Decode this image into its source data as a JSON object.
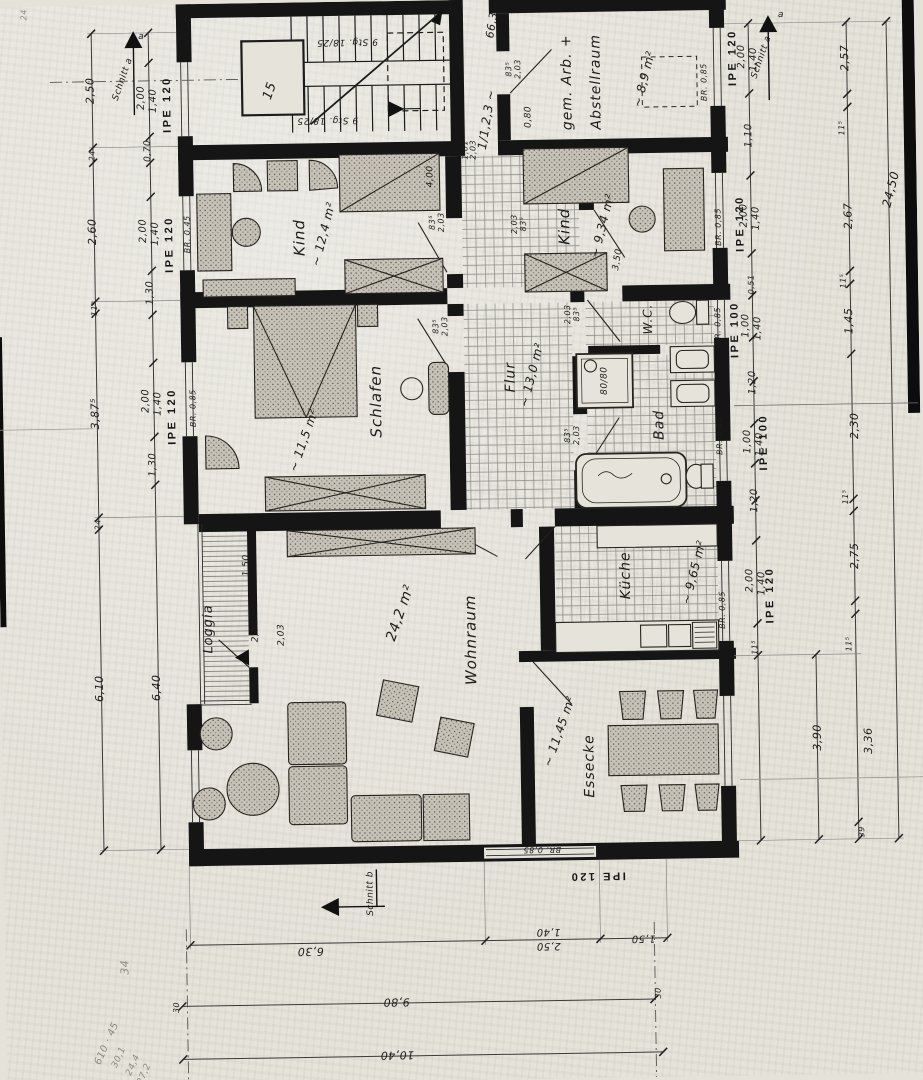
{
  "palette": {
    "paper": "#e6e3db",
    "ink": "#151514",
    "hatch": "#8a8a85",
    "pencil": "#8e8b84",
    "wall": "#151515"
  },
  "labels": {
    "rooms": [
      {
        "n": "room-note-stair-shaft",
        "t": "15",
        "x": 278,
        "y": 88,
        "r": -70,
        "s": 13
      },
      {
        "n": "room-label-gem-arb-1",
        "t": "gem. Arb. +",
        "x": 575,
        "y": 84,
        "r": -90,
        "s": 14,
        "c": "big"
      },
      {
        "n": "room-label-gem-arb-2",
        "t": "Abstellraum",
        "x": 604,
        "y": 84,
        "r": -90,
        "s": 14,
        "c": "big"
      },
      {
        "n": "room-area-gem-arb",
        "t": "~ 8,9 m²",
        "x": 652,
        "y": 82,
        "r": -75,
        "s": 12
      },
      {
        "n": "room-label-kind-1",
        "t": "Kind",
        "x": 305,
        "y": 235,
        "r": -90,
        "s": 15,
        "c": "big"
      },
      {
        "n": "room-area-kind-1",
        "t": "~ 12,4 m²",
        "x": 329,
        "y": 232,
        "r": -75,
        "s": 12
      },
      {
        "n": "room-label-kind-2",
        "t": "Kind",
        "x": 570,
        "y": 228,
        "r": -90,
        "s": 15,
        "c": "big"
      },
      {
        "n": "room-area-kind-2",
        "t": "~ 9,34 m²",
        "x": 608,
        "y": 228,
        "r": -75,
        "s": 12
      },
      {
        "n": "room-label-schlafen",
        "t": "Schlafen",
        "x": 379,
        "y": 400,
        "r": -90,
        "s": 15,
        "c": "big"
      },
      {
        "n": "room-area-schlafen",
        "t": "~ 11,5 m²",
        "x": 306,
        "y": 438,
        "r": -70,
        "s": 12
      },
      {
        "n": "room-label-flur",
        "t": "Flur",
        "x": 514,
        "y": 378,
        "r": -90,
        "s": 14,
        "c": "big"
      },
      {
        "n": "room-area-flur",
        "t": "~ 13,0 m²",
        "x": 535,
        "y": 376,
        "r": -75,
        "s": 12
      },
      {
        "n": "room-label-wc",
        "t": "W.C.",
        "x": 652,
        "y": 322,
        "r": -90,
        "s": 12,
        "c": "big"
      },
      {
        "n": "room-label-bad",
        "t": "Bad",
        "x": 662,
        "y": 428,
        "r": -90,
        "s": 14,
        "c": "big"
      },
      {
        "n": "room-label-kueche",
        "t": "Küche",
        "x": 626,
        "y": 578,
        "r": -90,
        "s": 14,
        "c": "big"
      },
      {
        "n": "room-area-kueche",
        "t": "~ 9,65 m²",
        "x": 694,
        "y": 576,
        "r": -75,
        "s": 12
      },
      {
        "n": "room-label-wohnraum",
        "t": "Wohnraum",
        "x": 470,
        "y": 640,
        "r": -90,
        "s": 15,
        "c": "big"
      },
      {
        "n": "room-area-wohnraum",
        "t": "24,2 m²",
        "x": 400,
        "y": 612,
        "r": -70,
        "s": 14
      },
      {
        "n": "room-label-essecke",
        "t": "Essecke",
        "x": 587,
        "y": 768,
        "r": -90,
        "s": 14,
        "c": "big"
      },
      {
        "n": "room-area-essecke",
        "t": "~ 11,45 m²",
        "x": 557,
        "y": 733,
        "r": -70,
        "s": 12
      },
      {
        "n": "room-label-loggia",
        "t": "Loggia",
        "x": 208,
        "y": 625,
        "r": -90,
        "s": 13,
        "c": "big"
      }
    ],
    "stairs": [
      {
        "n": "stair-note-upper-flight",
        "t": "9 Stg. 18/25",
        "x": 356,
        "y": 40,
        "r": 180,
        "s": 9
      },
      {
        "n": "stair-note-lower-flight",
        "t": "9 Stg. 18/25",
        "x": 335,
        "y": 118,
        "r": 180,
        "s": 9
      }
    ],
    "fixtures": [
      {
        "n": "shower-size-note",
        "t": "80/80",
        "x": 608,
        "y": 383,
        "r": -90,
        "s": 9
      }
    ],
    "beams": [
      {
        "n": "beam-label-left-1",
        "t": "IPE 120",
        "x": 175,
        "y": 100,
        "r": -90,
        "s": 11,
        "c": "beam"
      },
      {
        "n": "beam-label-left-2",
        "t": "IPE 120",
        "x": 175,
        "y": 240,
        "r": -90,
        "s": 11,
        "c": "beam"
      },
      {
        "n": "beam-label-left-3",
        "t": "IPE 120",
        "x": 175,
        "y": 412,
        "r": -90,
        "s": 11,
        "c": "beam"
      },
      {
        "n": "beam-label-right-1",
        "t": "IPE 120",
        "x": 741,
        "y": 62,
        "r": -90,
        "s": 11,
        "c": "beam"
      },
      {
        "n": "beam-label-right-2",
        "t": "IPE 120",
        "x": 746,
        "y": 228,
        "r": -90,
        "s": 11,
        "c": "beam"
      },
      {
        "n": "beam-label-right-3",
        "t": "IPE 100",
        "x": 739,
        "y": 334,
        "r": -90,
        "s": 11,
        "c": "beam"
      },
      {
        "n": "beam-label-right-4",
        "t": "IPE 100",
        "x": 766,
        "y": 447,
        "r": -90,
        "s": 11,
        "c": "beam"
      },
      {
        "n": "beam-label-right-5",
        "t": "IPE 120",
        "x": 770,
        "y": 600,
        "r": -90,
        "s": 11,
        "c": "beam"
      },
      {
        "n": "beam-label-bottom",
        "t": "IPE 120",
        "x": 593,
        "y": 878,
        "r": 180,
        "s": 11,
        "c": "beam"
      }
    ],
    "parapets": [
      {
        "n": "parapet-note",
        "t": "BR. 0,45",
        "x": 193,
        "y": 230,
        "r": -90,
        "s": 8
      },
      {
        "n": "parapet-note",
        "t": "BR. 0,85",
        "x": 196,
        "y": 404,
        "r": -90,
        "s": 8
      },
      {
        "n": "parapet-note",
        "t": "BR. 0,85",
        "x": 712,
        "y": 86,
        "r": -90,
        "s": 8
      },
      {
        "n": "parapet-note",
        "t": "BR. 0,85",
        "x": 724,
        "y": 231,
        "r": -90,
        "s": 8
      },
      {
        "n": "parapet-note",
        "t": "BR. 0,85",
        "x": 722,
        "y": 330,
        "r": -90,
        "s": 8
      },
      {
        "n": "parapet-note",
        "t": "BR. 0,85",
        "x": 722,
        "y": 440,
        "r": -90,
        "s": 8
      },
      {
        "n": "parapet-note",
        "t": "BR. 0,85",
        "x": 722,
        "y": 614,
        "r": -90,
        "s": 8
      },
      {
        "n": "parapet-note",
        "t": "BR. 0,85",
        "x": 538,
        "y": 851,
        "r": 180,
        "s": 8
      }
    ],
    "sections": [
      {
        "n": "section-label-a-left",
        "t": "Schnitt a",
        "x": 131,
        "y": 74,
        "r": -70,
        "s": 9
      },
      {
        "n": "section-letter-a-left",
        "t": "a",
        "x": 150,
        "y": 32,
        "r": 0,
        "s": 9
      },
      {
        "n": "section-label-a-right",
        "t": "Schnitt a",
        "x": 770,
        "y": 62,
        "r": -70,
        "s": 9
      },
      {
        "n": "section-letter-a-right",
        "t": "a",
        "x": 790,
        "y": 20,
        "r": 0,
        "s": 9
      },
      {
        "n": "section-label-b",
        "t": "Schnitt b",
        "x": 366,
        "y": 892,
        "r": -90,
        "s": 9
      }
    ],
    "dims_left": [
      {
        "t": "2,50",
        "x": 98,
        "y": 85,
        "r": -90,
        "s": 11
      },
      {
        "t": "24",
        "x": 99,
        "y": 150,
        "r": -90,
        "s": 8
      },
      {
        "t": "2,60",
        "x": 98,
        "y": 226,
        "r": -90,
        "s": 11
      },
      {
        "t": "11⁵",
        "x": 99,
        "y": 303,
        "r": -90,
        "s": 8
      },
      {
        "t": "3,87⁵",
        "x": 98,
        "y": 408,
        "r": -90,
        "s": 11
      },
      {
        "t": "24",
        "x": 99,
        "y": 519,
        "r": -90,
        "s": 8
      },
      {
        "t": "6,10",
        "x": 98,
        "y": 683,
        "r": -90,
        "s": 11
      },
      {
        "t": "2,00",
        "x": 149,
        "y": 93,
        "r": -90,
        "s": 10
      },
      {
        "t": "1,40",
        "x": 161,
        "y": 96,
        "r": -90,
        "s": 10
      },
      {
        "t": "0,70",
        "x": 155,
        "y": 146,
        "r": -90,
        "s": 9
      },
      {
        "t": "2,00",
        "x": 149,
        "y": 226,
        "r": -90,
        "s": 10
      },
      {
        "t": "1,40",
        "x": 161,
        "y": 229,
        "r": -90,
        "s": 10
      },
      {
        "t": "1,30",
        "x": 155,
        "y": 288,
        "r": -90,
        "s": 10
      },
      {
        "t": "2,00",
        "x": 149,
        "y": 396,
        "r": -90,
        "s": 10
      },
      {
        "t": "1,40",
        "x": 161,
        "y": 399,
        "r": -90,
        "s": 10
      },
      {
        "t": "1,30",
        "x": 155,
        "y": 460,
        "r": -90,
        "s": 10
      },
      {
        "t": "6,40",
        "x": 155,
        "y": 683,
        "r": -90,
        "s": 11
      },
      {
        "t": "24",
        "x": 33,
        "y": 8,
        "r": -90,
        "s": 8,
        "c": "faint"
      }
    ],
    "dims_right": [
      {
        "t": "2,00",
        "x": 750,
        "y": 61,
        "r": -90,
        "s": 10
      },
      {
        "t": "1,40",
        "x": 762,
        "y": 64,
        "r": -90,
        "s": 10
      },
      {
        "t": "1,10",
        "x": 756,
        "y": 140,
        "r": -90,
        "s": 10
      },
      {
        "t": "2,00",
        "x": 750,
        "y": 220,
        "r": -90,
        "s": 10
      },
      {
        "t": "1,40",
        "x": 762,
        "y": 223,
        "r": -90,
        "s": 10
      },
      {
        "t": "0,51",
        "x": 756,
        "y": 289,
        "r": -90,
        "s": 8
      },
      {
        "t": "1,00",
        "x": 750,
        "y": 330,
        "r": -90,
        "s": 10
      },
      {
        "t": "1,40",
        "x": 762,
        "y": 333,
        "r": -90,
        "s": 10
      },
      {
        "t": "1,20",
        "x": 756,
        "y": 387,
        "r": -90,
        "s": 10
      },
      {
        "t": "1,00",
        "x": 750,
        "y": 446,
        "r": -90,
        "s": 10
      },
      {
        "t": "1,40",
        "x": 762,
        "y": 449,
        "r": -90,
        "s": 10
      },
      {
        "t": "1,20",
        "x": 756,
        "y": 505,
        "r": -90,
        "s": 10
      },
      {
        "t": "2,00",
        "x": 750,
        "y": 585,
        "r": -90,
        "s": 10
      },
      {
        "t": "1,40",
        "x": 762,
        "y": 588,
        "r": -90,
        "s": 10
      },
      {
        "t": "11⁵",
        "x": 754,
        "y": 652,
        "r": -90,
        "s": 8
      },
      {
        "t": "2,57",
        "x": 853,
        "y": 64,
        "r": -90,
        "s": 11
      },
      {
        "t": "11⁵",
        "x": 849,
        "y": 134,
        "r": -90,
        "s": 8
      },
      {
        "t": "2,67",
        "x": 854,
        "y": 222,
        "r": -90,
        "s": 11
      },
      {
        "t": "11⁵",
        "x": 848,
        "y": 287,
        "r": -90,
        "s": 8
      },
      {
        "t": "1,45",
        "x": 853,
        "y": 327,
        "r": -90,
        "s": 11
      },
      {
        "t": "2,30",
        "x": 857,
        "y": 432,
        "r": -90,
        "s": 11
      },
      {
        "t": "11⁵",
        "x": 847,
        "y": 503,
        "r": -90,
        "s": 8
      },
      {
        "t": "2,75",
        "x": 855,
        "y": 562,
        "r": -90,
        "s": 11
      },
      {
        "t": "11⁵",
        "x": 848,
        "y": 650,
        "r": -90,
        "s": 8
      },
      {
        "t": "3,90",
        "x": 815,
        "y": 743,
        "r": -90,
        "s": 11
      },
      {
        "t": "3,36",
        "x": 866,
        "y": 747,
        "r": -90,
        "s": 11
      },
      {
        "t": "39",
        "x": 858,
        "y": 838,
        "r": -90,
        "s": 8
      },
      {
        "t": "24,50",
        "x": 897,
        "y": 196,
        "r": -75,
        "s": 12
      }
    ],
    "dims_bottom": [
      {
        "t": "6,30",
        "x": 305,
        "y": 949,
        "r": 180,
        "s": 11
      },
      {
        "t": "1,40",
        "x": 543,
        "y": 933,
        "r": 180,
        "s": 10
      },
      {
        "t": "2,50",
        "x": 543,
        "y": 947,
        "r": 180,
        "s": 10
      },
      {
        "t": "1,50",
        "x": 638,
        "y": 941,
        "r": 180,
        "s": 10
      },
      {
        "t": "9,80",
        "x": 390,
        "y": 1001,
        "r": 180,
        "s": 11
      },
      {
        "t": "30",
        "x": 170,
        "y": 1003,
        "r": -90,
        "s": 8
      },
      {
        "t": "30",
        "x": 652,
        "y": 996,
        "r": -90,
        "s": 8
      },
      {
        "t": "10,40",
        "x": 390,
        "y": 1054,
        "r": 180,
        "s": 11
      }
    ],
    "door_dims": [
      {
        "t": "83⁵",
        "x": 517,
        "y": 70,
        "r": -90,
        "s": 8
      },
      {
        "t": "2,03",
        "x": 526,
        "y": 70,
        "r": -90,
        "s": 8
      },
      {
        "t": "83⁵",
        "x": 438,
        "y": 222,
        "r": -90,
        "s": 8
      },
      {
        "t": "2,03",
        "x": 447,
        "y": 222,
        "r": -90,
        "s": 8
      },
      {
        "t": "2,03",
        "x": 520,
        "y": 225,
        "r": -90,
        "s": 8
      },
      {
        "t": "83⁵",
        "x": 529,
        "y": 225,
        "r": -90,
        "s": 8
      },
      {
        "t": "83⁵",
        "x": 440,
        "y": 326,
        "r": -90,
        "s": 8
      },
      {
        "t": "2,03",
        "x": 449,
        "y": 326,
        "r": -90,
        "s": 8
      },
      {
        "t": "2,03",
        "x": 572,
        "y": 316,
        "r": -90,
        "s": 8
      },
      {
        "t": "83⁵",
        "x": 581,
        "y": 316,
        "r": -90,
        "s": 8
      },
      {
        "t": "83⁵",
        "x": 570,
        "y": 437,
        "r": -90,
        "s": 8
      },
      {
        "t": "2,03",
        "x": 579,
        "y": 437,
        "r": -90,
        "s": 8
      },
      {
        "t": "0,80",
        "x": 536,
        "y": 118,
        "r": -90,
        "s": 9
      },
      {
        "t": "2,03",
        "x": 281,
        "y": 632,
        "r": -90,
        "s": 9
      }
    ],
    "interior_dims": [
      {
        "t": "4,00",
        "x": 437,
        "y": 176,
        "r": -90,
        "s": 9
      },
      {
        "t": "3,50",
        "x": 623,
        "y": 262,
        "r": -80,
        "s": 9
      },
      {
        "t": "1,50",
        "x": 247,
        "y": 562,
        "r": -90,
        "s": 9
      },
      {
        "t": "2,00",
        "x": 255,
        "y": 628,
        "r": -90,
        "s": 9
      }
    ],
    "notes": [
      {
        "n": "margin-note",
        "t": "66,3 —",
        "x": 502,
        "y": 18,
        "r": -80,
        "s": 11
      },
      {
        "n": "margin-note",
        "t": "1/1,2,3 ~",
        "x": 494,
        "y": 120,
        "r": -80,
        "s": 12
      },
      {
        "n": "margin-note",
        "t": "2,03",
        "x": 480,
        "y": 150,
        "r": -90,
        "s": 8
      },
      {
        "n": "margin-note",
        "t": "1,01",
        "x": 472,
        "y": 150,
        "r": -90,
        "s": 8
      },
      {
        "n": "pencil-note",
        "t": "34",
        "x": 119,
        "y": 962,
        "r": -90,
        "s": 11,
        "c": "faint"
      },
      {
        "n": "pencil-note",
        "t": "610 · 45",
        "x": 100,
        "y": 1038,
        "r": -65,
        "s": 10,
        "c": "faint"
      },
      {
        "n": "pencil-note",
        "t": "30,1",
        "x": 112,
        "y": 1052,
        "r": -65,
        "s": 9,
        "c": "faint"
      },
      {
        "n": "pencil-note",
        "t": "24,4",
        "x": 126,
        "y": 1060,
        "r": -65,
        "s": 9,
        "c": "faint"
      },
      {
        "n": "pencil-note",
        "t": "27,2",
        "x": 137,
        "y": 1069,
        "r": -65,
        "s": 9,
        "c": "faint"
      }
    ]
  }
}
